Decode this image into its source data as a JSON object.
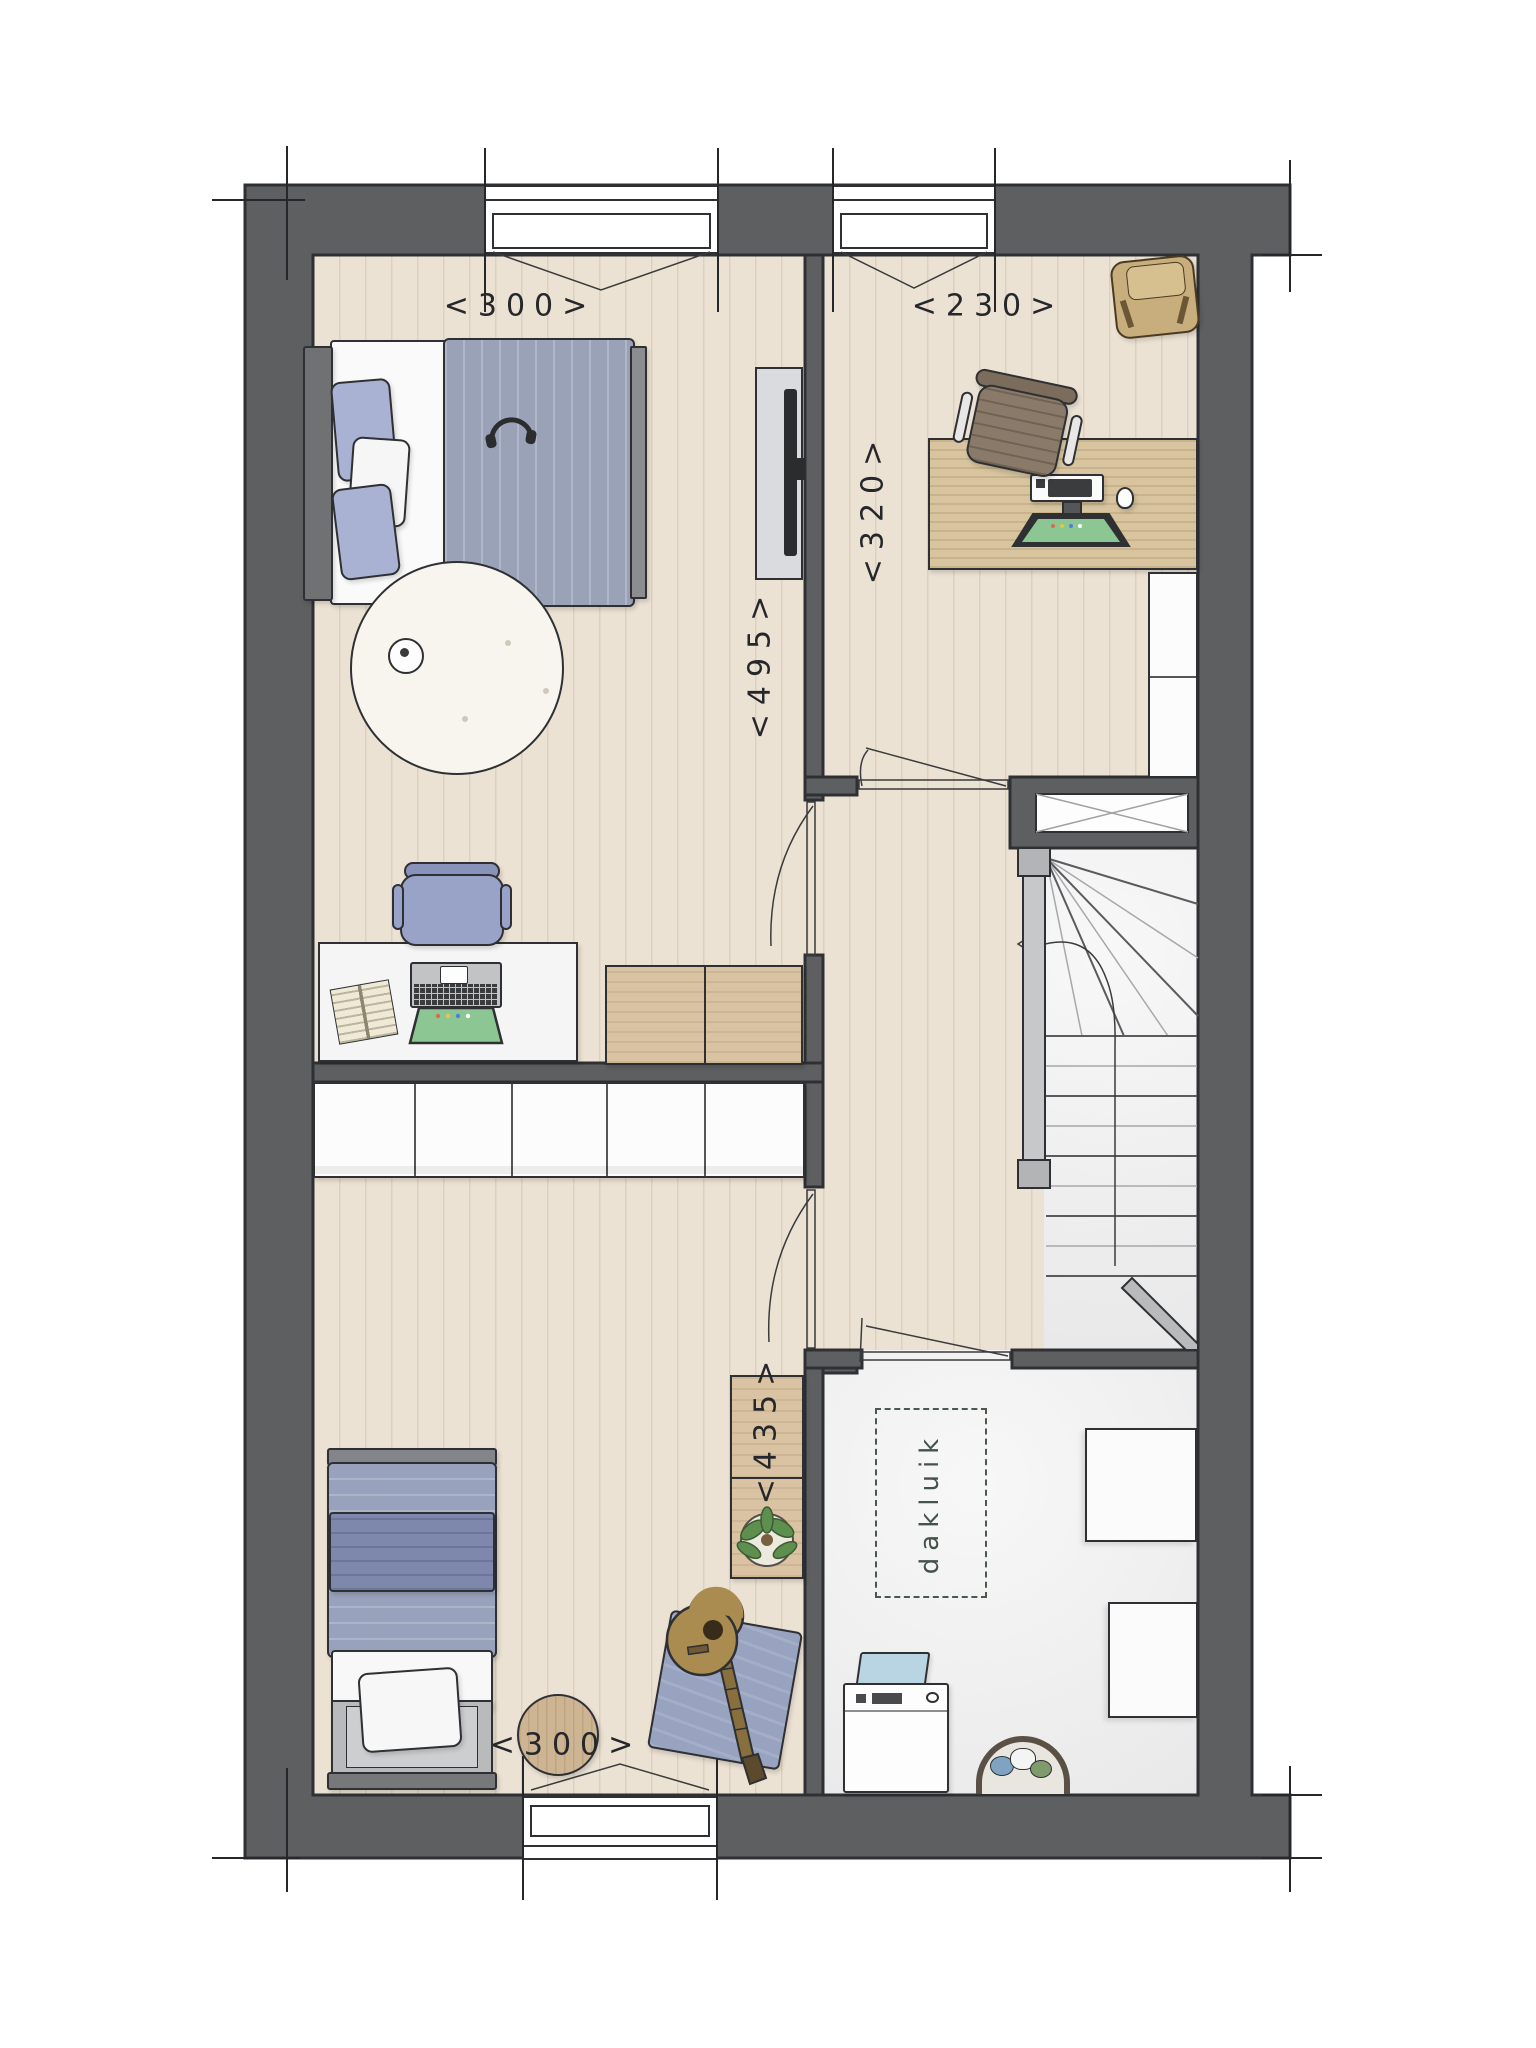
{
  "plan": {
    "dimensions": {
      "bedroom1_width": "<300>",
      "bedroom1_depth": "<495>",
      "bedroom2_width": "<230>",
      "bedroom2_depth": "<320>",
      "bedroom3_width": "<300>",
      "bedroom3_depth": "<435>"
    },
    "annotations": {
      "roof_hatch": "dakluik"
    },
    "colors": {
      "wall": "#5d5f61",
      "wall_outline": "#2e3033",
      "floor_wood": "#ece2d4",
      "floor_concrete": "#f0f0f1",
      "dimension_text": "#26272b",
      "annotation_text": "#44524a",
      "accent_blue": "#99a2bc",
      "accent_tan": "#d9c3a3",
      "screen_green": "#8cc793"
    }
  }
}
